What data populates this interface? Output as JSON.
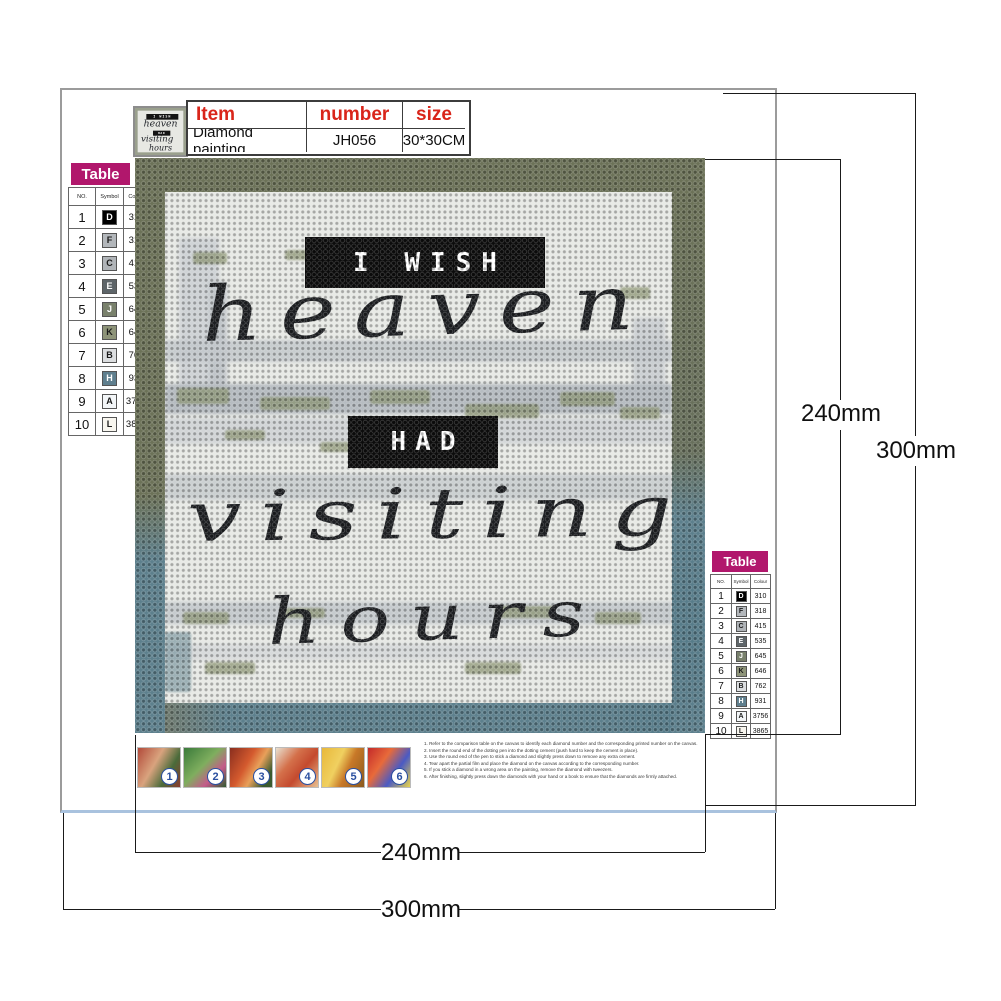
{
  "item_table": {
    "headers": [
      "Item",
      "number",
      "size"
    ],
    "row": [
      "Diamond painting",
      "JH056",
      "30*30CM"
    ]
  },
  "color_table": {
    "title": "Table",
    "columns": [
      "NO.",
      "Symbol",
      "Colour"
    ],
    "rows": [
      {
        "no": "1",
        "symbol": "D",
        "code": "310",
        "bg": "#000000",
        "fg": "#ffffff"
      },
      {
        "no": "2",
        "symbol": "F",
        "code": "318",
        "bg": "#b3b7bb",
        "fg": "#1a1a1a"
      },
      {
        "no": "3",
        "symbol": "C",
        "code": "415",
        "bg": "#b0b4b8",
        "fg": "#1a1a1a"
      },
      {
        "no": "4",
        "symbol": "E",
        "code": "535",
        "bg": "#5e6569",
        "fg": "#ffffff"
      },
      {
        "no": "5",
        "symbol": "J",
        "code": "645",
        "bg": "#79816c",
        "fg": "#ffffff"
      },
      {
        "no": "6",
        "symbol": "K",
        "code": "646",
        "bg": "#8e9479",
        "fg": "#1a1a1a"
      },
      {
        "no": "7",
        "symbol": "B",
        "code": "762",
        "bg": "#dcdee0",
        "fg": "#1a1a1a"
      },
      {
        "no": "8",
        "symbol": "H",
        "code": "931",
        "bg": "#5f7f8e",
        "fg": "#ffffff"
      },
      {
        "no": "9",
        "symbol": "A",
        "code": "3756",
        "bg": "#f3f6f8",
        "fg": "#1a1a1a"
      },
      {
        "no": "10",
        "symbol": "L",
        "code": "3865",
        "bg": "#f8f6ef",
        "fg": "#1a1a1a"
      }
    ]
  },
  "canvas_text": {
    "banner1": "I WISH",
    "script1": "heaven",
    "banner2": "HAD",
    "script2": "visiting",
    "script3": "hours"
  },
  "steps": [
    "1. Refer to the comparison table on the canvas to identify each diamond number and the corresponding printed number on the canvas.",
    "2. Insert the round end of the dotting pen into the dotting cement (push hard to keep the cement in place).",
    "3. Use the round end of the pen to stick a diamond and slightly press down to remove any extra cement.",
    "4. Tear apart the partial film and place the diamond on the canvas according to the corresponding number.",
    "5. If you stick a diamond in a wrong area on the painting, remove the diamond with tweezers.",
    "6. After finishing, slightly press down the diamonds with your hand or a book to ensure that the diamonds are firmly attached."
  ],
  "step_numbers": [
    "1",
    "2",
    "3",
    "4",
    "5",
    "6"
  ],
  "dimensions": {
    "inner_height": "240mm",
    "outer_height": "300mm",
    "inner_width": "240mm",
    "outer_width": "300mm"
  },
  "colors": {
    "magenta": "#b1176c",
    "header_red": "#d9251a",
    "olive": "#6c7258",
    "teal": "#5d808d",
    "card_border": "#9b9b9b",
    "card_bottom_border": "#a9c2de",
    "dimension_line": "#1a1a1a"
  }
}
